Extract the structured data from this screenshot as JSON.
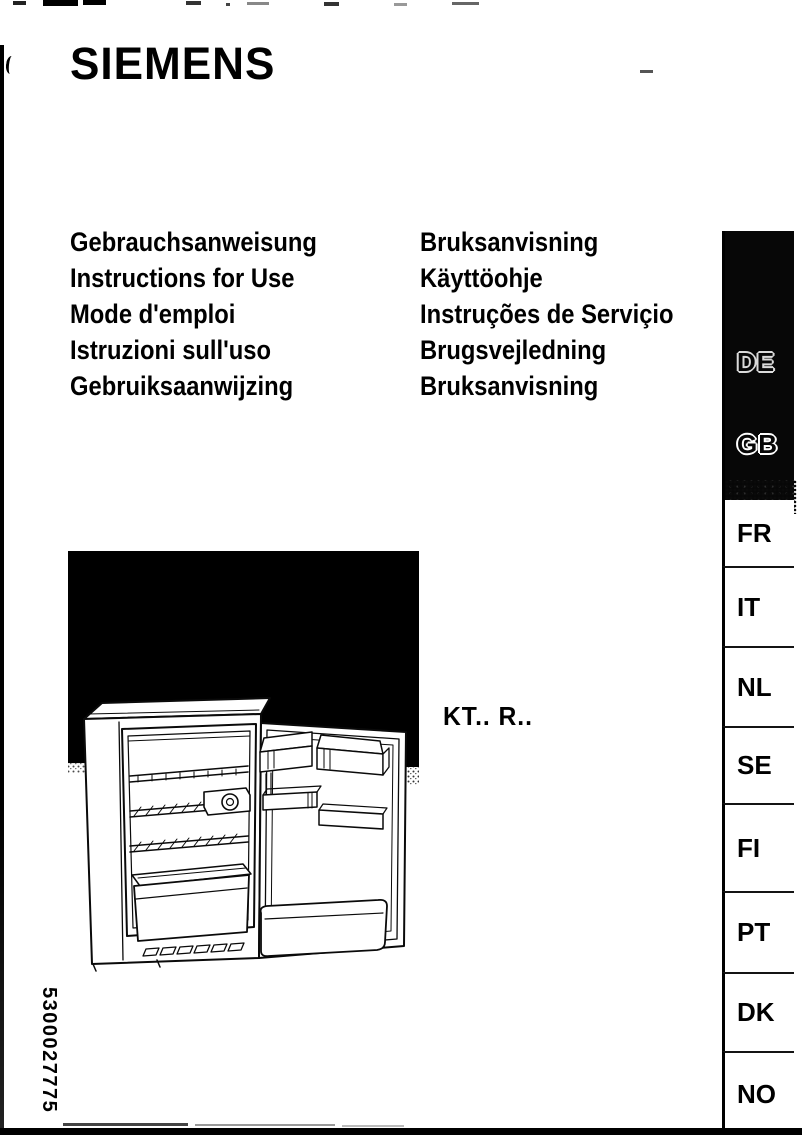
{
  "brand": "SIEMENS",
  "model": "KT.. R..",
  "document_number": "5300027775",
  "titles_left": [
    "Gebrauchsanweisung",
    "Instructions for Use",
    "Mode d'emploi",
    "Istruzioni sull'uso",
    "Gebruiksaanwijzing"
  ],
  "titles_right": [
    "Bruksanvisning",
    "Käyttöohje",
    "Instruções de Serviçio",
    "Brugsvejledning",
    "Bruksanvisning"
  ],
  "language_tabs": {
    "dark": [
      "DE",
      "GB"
    ],
    "light": [
      "FR",
      "IT",
      "NL",
      "SE",
      "FI",
      "PT",
      "DK",
      "NO"
    ]
  },
  "colors": {
    "ink": "#000000",
    "paper": "#ffffff"
  }
}
